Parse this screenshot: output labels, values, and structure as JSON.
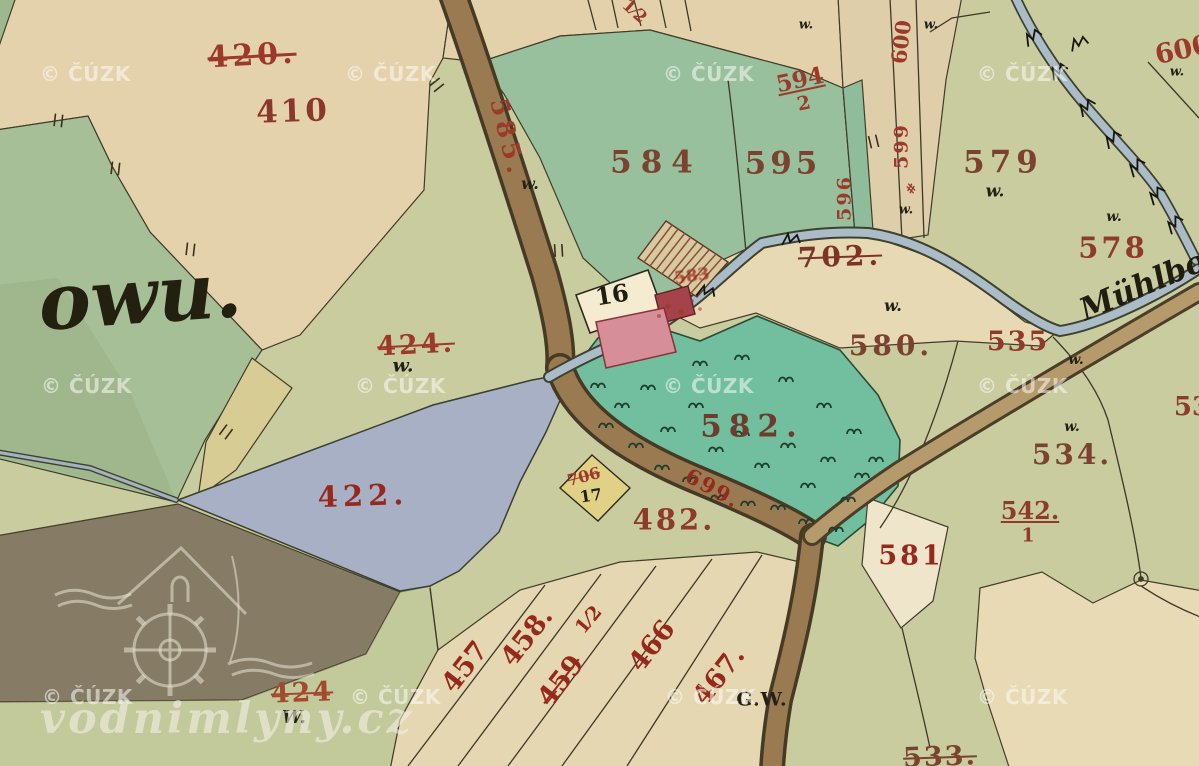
{
  "map": {
    "labels": [
      {
        "id": "p420",
        "t": "420.",
        "x": 252,
        "y": 56,
        "s": 30,
        "rot": -3,
        "c": "#9c392b",
        "ls": 4,
        "strike": 1
      },
      {
        "id": "p410",
        "t": "410",
        "x": 293,
        "y": 112,
        "s": 31,
        "rot": -2,
        "c": "#8a372c",
        "ls": 3
      },
      {
        "id": "owu",
        "t": "owu.",
        "x": 140,
        "y": 297,
        "s": 78,
        "rot": -4,
        "c": "#23200f",
        "f": "cursive"
      },
      {
        "id": "p585",
        "t": "585.",
        "x": 508,
        "y": 138,
        "s": 25,
        "rot": 76,
        "c": "#9c392b",
        "ls": 5
      },
      {
        "id": "w585",
        "t": "w.",
        "x": 530,
        "y": 184,
        "s": 16,
        "c": "#232114",
        "f": "cursive"
      },
      {
        "id": "p584",
        "t": "584",
        "x": 656,
        "y": 163,
        "s": 31,
        "c": "#7b432f",
        "ls": 9
      },
      {
        "id": "p595",
        "t": "595",
        "x": 783,
        "y": 164,
        "s": 31,
        "c": "#7b432f",
        "ls": 4
      },
      {
        "id": "p594",
        "t": "594",
        "x": 800,
        "y": 80,
        "s": 23,
        "rot": -12,
        "c": "#9c392b",
        "u": 1
      },
      {
        "id": "p594b",
        "t": "2",
        "x": 804,
        "y": 104,
        "s": 19,
        "rot": -12,
        "c": "#9c392b"
      },
      {
        "id": "frac12",
        "t": "1⁄2",
        "x": 634,
        "y": 12,
        "s": 17,
        "rot": 42,
        "c": "#9c392b"
      },
      {
        "id": "p596",
        "t": "596",
        "x": 845,
        "y": 198,
        "s": 19,
        "rot": -90,
        "c": "#9c392b",
        "ls": 2
      },
      {
        "id": "p599",
        "t": "599",
        "x": 902,
        "y": 146,
        "s": 19,
        "rot": -90,
        "c": "#9c392b",
        "ls": 2
      },
      {
        "id": "hash599",
        "t": "#",
        "x": 912,
        "y": 189,
        "s": 13,
        "rot": -60,
        "c": "#9c392b"
      },
      {
        "id": "w599",
        "t": "w.",
        "x": 906,
        "y": 210,
        "s": 13,
        "c": "#232114",
        "f": "cursive"
      },
      {
        "id": "p600",
        "t": "600",
        "x": 901,
        "y": 42,
        "s": 21,
        "rot": -83,
        "c": "#9c392b"
      },
      {
        "id": "w600",
        "t": "w.",
        "x": 931,
        "y": 25,
        "s": 13,
        "c": "#232114",
        "f": "cursive"
      },
      {
        "id": "w800",
        "t": "w.",
        "x": 806,
        "y": 25,
        "s": 13,
        "c": "#232114",
        "f": "cursive"
      },
      {
        "id": "p600r",
        "t": "600",
        "x": 1183,
        "y": 50,
        "s": 27,
        "rot": -12,
        "c": "#9c392b"
      },
      {
        "id": "w600r",
        "t": "w.",
        "x": 1177,
        "y": 72,
        "s": 13,
        "c": "#232114",
        "f": "cursive"
      },
      {
        "id": "p579",
        "t": "579",
        "x": 1003,
        "y": 163,
        "s": 31,
        "c": "#7b432f",
        "ls": 5
      },
      {
        "id": "w579",
        "t": "w.",
        "x": 995,
        "y": 192,
        "s": 17,
        "c": "#232114",
        "f": "cursive"
      },
      {
        "id": "w578",
        "t": "w.",
        "x": 1114,
        "y": 217,
        "s": 14,
        "c": "#232114",
        "f": "cursive"
      },
      {
        "id": "p578",
        "t": "578",
        "x": 1113,
        "y": 248,
        "s": 29,
        "c": "#8f3b2b",
        "ls": 3
      },
      {
        "id": "muhlbach",
        "t": "Mühlbo",
        "x": 1143,
        "y": 286,
        "s": 31,
        "rot": -23,
        "c": "#1f1d10",
        "f": "cursive"
      },
      {
        "id": "p702",
        "t": "702.",
        "x": 840,
        "y": 257,
        "s": 28,
        "rot": -2,
        "c": "#7b3527",
        "ls": 4,
        "strike": 1
      },
      {
        "id": "w580",
        "t": "w.",
        "x": 893,
        "y": 306,
        "s": 16,
        "c": "#232114",
        "f": "cursive"
      },
      {
        "id": "p580",
        "t": "580.",
        "x": 891,
        "y": 346,
        "s": 28,
        "c": "#7b432f",
        "ls": 4
      },
      {
        "id": "p535",
        "t": "535",
        "x": 1018,
        "y": 342,
        "s": 27,
        "c": "#8f3b2b",
        "ls": 2
      },
      {
        "id": "w535",
        "t": "w.",
        "x": 1076,
        "y": 360,
        "s": 14,
        "c": "#232114",
        "f": "cursive"
      },
      {
        "id": "w534",
        "t": "w.",
        "x": 1072,
        "y": 427,
        "s": 14,
        "c": "#232114",
        "f": "cursive"
      },
      {
        "id": "p534",
        "t": "534.",
        "x": 1072,
        "y": 455,
        "s": 28,
        "c": "#7b432f",
        "ls": 3
      },
      {
        "id": "p53x",
        "t": "53",
        "x": 1192,
        "y": 407,
        "s": 26,
        "c": "#8f3b2b"
      },
      {
        "id": "b16",
        "t": "16",
        "x": 612,
        "y": 295,
        "s": 24,
        "rot": -9,
        "c": "#1f1d10"
      },
      {
        "id": "p706",
        "t": "706",
        "x": 584,
        "y": 477,
        "s": 16,
        "rot": -15,
        "c": "#9c392b",
        "strike": 1
      },
      {
        "id": "b17",
        "t": "17",
        "x": 591,
        "y": 496,
        "s": 16,
        "rot": -9,
        "c": "#1f1d10"
      },
      {
        "id": "p583",
        "t": "583",
        "x": 692,
        "y": 277,
        "s": 17,
        "rot": -8,
        "c": "#96291c",
        "strike": 1,
        "dim": 0.8,
        "blur": 1
      },
      {
        "id": "p699",
        "t": "699.",
        "x": 713,
        "y": 488,
        "s": 21,
        "rot": 29,
        "c": "#96291c",
        "ls": 2
      },
      {
        "id": "p582",
        "t": "582.",
        "x": 752,
        "y": 427,
        "s": 31,
        "c": "#6e3c2b",
        "ls": 7
      },
      {
        "id": "p482",
        "t": "482.",
        "x": 674,
        "y": 520,
        "s": 29,
        "c": "#8f3b2b",
        "ls": 3
      },
      {
        "id": "p424",
        "t": "424.",
        "x": 416,
        "y": 345,
        "s": 27,
        "rot": -3,
        "c": "#9c392b",
        "ls": 3,
        "strike": 1
      },
      {
        "id": "w424",
        "t": "w.",
        "x": 403,
        "y": 366,
        "s": 19,
        "c": "#232114",
        "f": "cursive"
      },
      {
        "id": "p422",
        "t": "422.",
        "x": 363,
        "y": 496,
        "s": 29,
        "rot": -2,
        "c": "#96291c",
        "ls": 5
      },
      {
        "id": "p542",
        "t": "542.",
        "x": 1030,
        "y": 511,
        "s": 24,
        "c": "#8f3b2b",
        "u": 1
      },
      {
        "id": "p542b",
        "t": "1",
        "x": 1028,
        "y": 536,
        "s": 19,
        "c": "#8f3b2b"
      },
      {
        "id": "p581",
        "t": "581",
        "x": 911,
        "y": 556,
        "s": 27,
        "c": "#96291c",
        "ls": 3
      },
      {
        "id": "p533",
        "t": "533.",
        "x": 940,
        "y": 757,
        "s": 27,
        "rot": -2,
        "c": "#7b432f",
        "ls": 2,
        "strike": 1
      },
      {
        "id": "p457",
        "t": "457",
        "x": 465,
        "y": 667,
        "s": 27,
        "rot": -52,
        "c": "#96291c"
      },
      {
        "id": "p458",
        "t": "458.",
        "x": 527,
        "y": 637,
        "s": 27,
        "rot": -52,
        "c": "#96291c"
      },
      {
        "id": "p459",
        "t": "459",
        "x": 561,
        "y": 681,
        "s": 27,
        "rot": -52,
        "c": "#96291c",
        "strike": 1
      },
      {
        "id": "p459f",
        "t": "1⁄2",
        "x": 589,
        "y": 620,
        "s": 19,
        "rot": -50,
        "c": "#96291c"
      },
      {
        "id": "p466",
        "t": "466",
        "x": 652,
        "y": 646,
        "s": 27,
        "rot": -52,
        "c": "#96291c"
      },
      {
        "id": "p467",
        "t": "467.",
        "x": 719,
        "y": 676,
        "s": 27,
        "rot": -52,
        "c": "#96291c"
      },
      {
        "id": "gw",
        "t": "G.W.",
        "x": 762,
        "y": 700,
        "s": 19,
        "c": "#232114",
        "ls": 1
      },
      {
        "id": "p424b",
        "t": "424",
        "x": 302,
        "y": 693,
        "s": 27,
        "rot": -2,
        "c": "#a34a2e",
        "ls": 2,
        "strike": 1
      },
      {
        "id": "w424b",
        "t": "W.",
        "x": 294,
        "y": 718,
        "s": 18,
        "c": "#232114",
        "f": "cursive"
      }
    ],
    "watermarks": {
      "cuzk": "© ČÚZK",
      "cuzk_positions": [
        [
          40,
          62
        ],
        [
          345,
          62
        ],
        [
          663,
          62
        ],
        [
          977,
          62
        ],
        [
          41,
          374
        ],
        [
          355,
          374
        ],
        [
          663,
          374
        ],
        [
          977,
          374
        ],
        [
          42,
          685
        ],
        [
          350,
          685
        ],
        [
          665,
          685
        ],
        [
          977,
          685
        ]
      ],
      "site": "vodnimlyny.cz",
      "logo": "watermill-logo"
    }
  }
}
